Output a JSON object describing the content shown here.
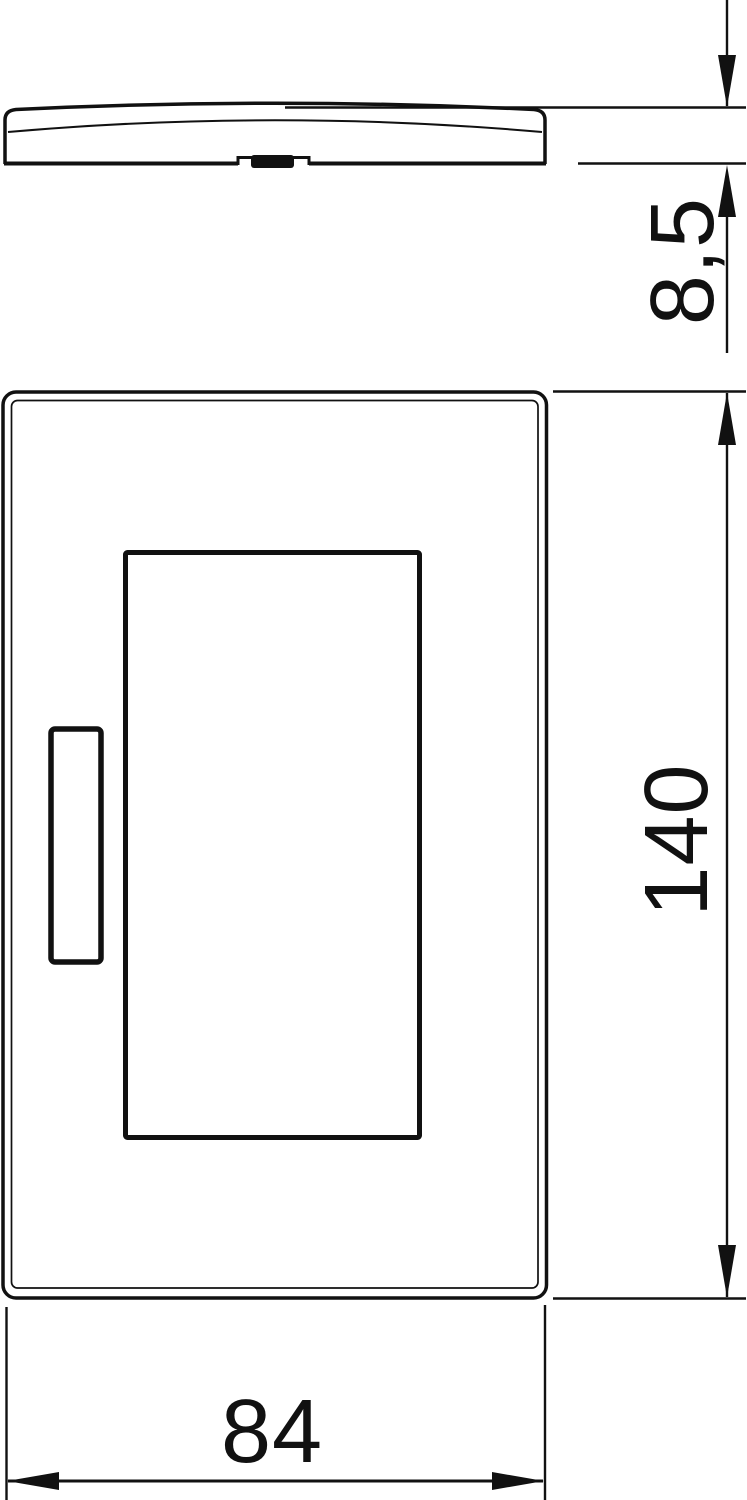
{
  "drawing": {
    "kind": "technical-dimension-drawing",
    "background_color": "#ffffff",
    "line_color": "#111111",
    "views": {
      "profile": {
        "name": "side-profile-of-cover-plate",
        "height_dimension": {
          "value": "8,5",
          "orientation": "rotated-90ccw"
        }
      },
      "front": {
        "name": "front-view-of-cover-plate",
        "height_dimension": {
          "value": "140",
          "orientation": "rotated-90ccw"
        },
        "width_dimension": {
          "value": "84",
          "orientation": "horizontal"
        }
      }
    }
  }
}
